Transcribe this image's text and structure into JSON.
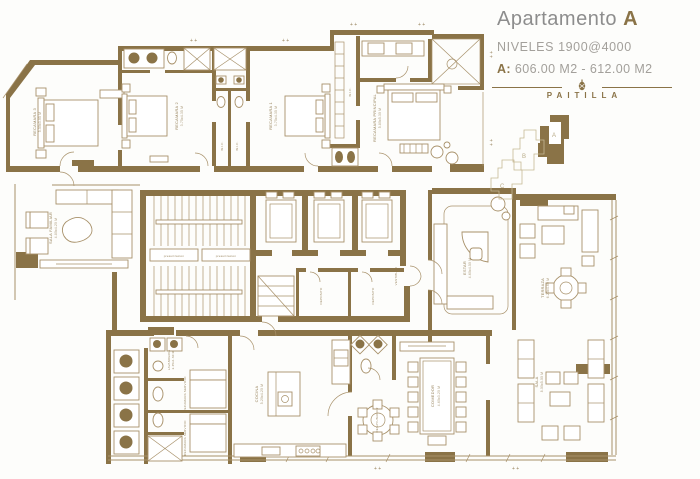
{
  "header": {
    "title": "Apartamento",
    "unit": "A",
    "subtitle": "NIVELES 1900@4000",
    "area_label": "A:",
    "area_value": "606.00 M2 - 612.00 M2",
    "brand": "PAITILLA"
  },
  "keyplan": {
    "a": "A",
    "b": "B",
    "c": "C"
  },
  "rooms": {
    "recamara3": {
      "name": "RECAMARA 3",
      "dims": "5.50x3.95 M"
    },
    "recamara2": {
      "name": "RECAMARA 2",
      "dims": "3.75x4.35 M"
    },
    "recamara1": {
      "name": "RECAMARA 1",
      "dims": "3.75x4.35 M"
    },
    "wic1": "W.I.C.",
    "wic2": "W.I.C.",
    "wic_master": "W.I.C.",
    "principal": {
      "name": "RECAMARA PRINCIPAL",
      "dims": "5.80x5.30 M"
    },
    "presurizacion": "presurizacion",
    "vestibulo": "VESTIBULO",
    "deposito1": "DEPOSITO",
    "deposito2": "DEPOSITO",
    "sala_familiar": {
      "name": "SALA FAMILIAR",
      "dims": "4.80x4.20 M"
    },
    "estar": {
      "name": "ESTAR",
      "dims": "4.60x4.50 M"
    },
    "terraza": {
      "name": "TERRAZA",
      "dims": "6.20x4.60 M"
    },
    "sala": {
      "name": "SALA",
      "dims": "8.00x5.00 M"
    },
    "comedor": {
      "name": "COMEDOR",
      "dims": "4.60x3.20 M"
    },
    "desayunador": {
      "name": "DESAYUNADOR"
    },
    "cocina": {
      "name": "COCINA",
      "dims": "5.20x4.20 M"
    },
    "lavanderia": {
      "name": "LAVANDERIA",
      "dims": "2.45x1.60 M"
    },
    "servicio1": {
      "name": "RECAMARA SERVICIO",
      "dims": "2.75x2.25 M"
    },
    "servicio2": {
      "name": "RECAMARA SERVICIO",
      "dims": "2.75x2.25 M"
    }
  },
  "misc": {
    "dim_marker": "+ +"
  },
  "colors": {
    "wall": "#8a7347",
    "line": "#a8916a"
  }
}
